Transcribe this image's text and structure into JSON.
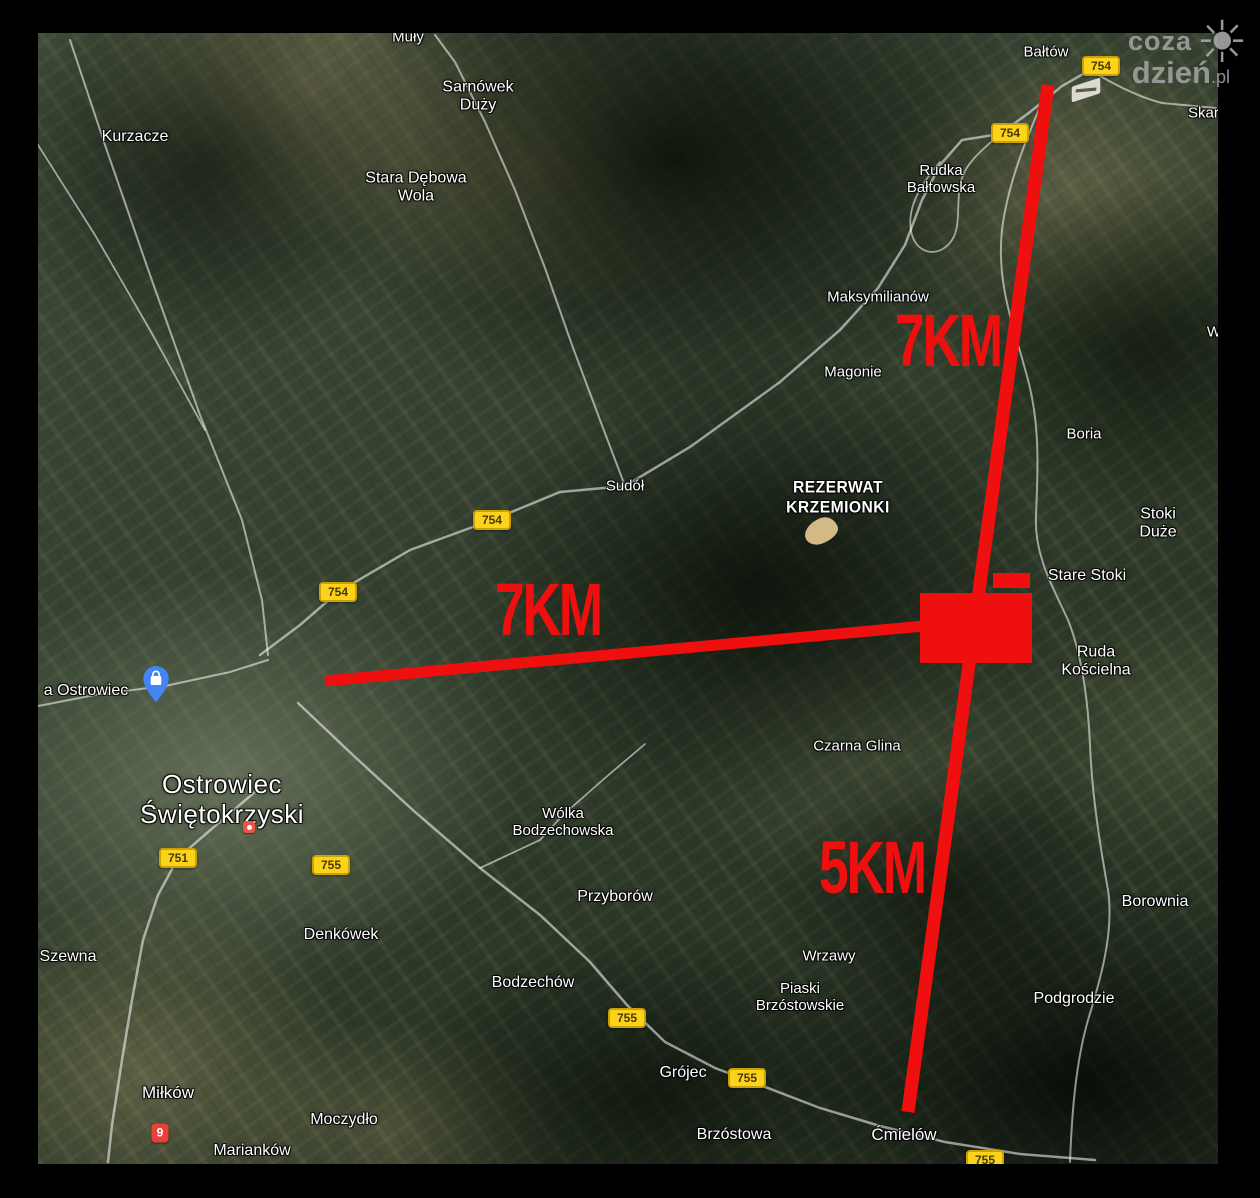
{
  "page": {
    "bg": "#000000",
    "map": {
      "left": 38,
      "top": 33,
      "width": 1180,
      "height": 1131
    }
  },
  "colors": {
    "annotation_red": "#ef0f0f",
    "shield_bg": "#fcd21b",
    "pin_blue": "#4285f4",
    "marker_red": "#e8413c",
    "label_white": "#ffffff",
    "road_white": "rgba(255,255,255,0.55)"
  },
  "watermark": {
    "line1": "coza",
    "line2": "dzień",
    "tld": ".pl",
    "sun_glyph": "☀"
  },
  "map_labels": [
    {
      "text": "Muły",
      "x": 408,
      "y": 37
    },
    {
      "text": "Kurzacze",
      "x": 135,
      "y": 137,
      "size": 16
    },
    {
      "text": "Sarnówek\nDuży",
      "x": 478,
      "y": 97,
      "size": 16
    },
    {
      "text": "Stara Dębowa\nWola",
      "x": 416,
      "y": 188,
      "size": 16
    },
    {
      "text": "Bałtów",
      "x": 1046,
      "y": 52
    },
    {
      "text": "Skarbka",
      "x": 1188,
      "y": 113,
      "anchor": "left"
    },
    {
      "text": "Rudka\nBałtowska",
      "x": 941,
      "y": 179
    },
    {
      "text": "Maksymilianów",
      "x": 878,
      "y": 297
    },
    {
      "text": "Magonie",
      "x": 853,
      "y": 372
    },
    {
      "text": "Boria",
      "x": 1084,
      "y": 434
    },
    {
      "text": "W",
      "x": 1214,
      "y": 332
    },
    {
      "text": "Sudół",
      "x": 625,
      "y": 486
    },
    {
      "text": "REZERWAT\nKRZEMIONKI",
      "x": 838,
      "y": 497,
      "cls": "reserve"
    },
    {
      "text": "Stoki Duże",
      "x": 1158,
      "y": 524,
      "size": 16
    },
    {
      "text": "Stare Stoki",
      "x": 1087,
      "y": 576,
      "size": 16
    },
    {
      "text": "Ruda\nKościelna",
      "x": 1096,
      "y": 662,
      "size": 16
    },
    {
      "text": "Czarna Glina",
      "x": 857,
      "y": 746
    },
    {
      "text": "a Ostrowiec",
      "x": 86,
      "y": 691,
      "size": 16
    },
    {
      "text": "Ostrowiec\nŚwiętokrzyski",
      "x": 222,
      "y": 800,
      "cls": "city"
    },
    {
      "text": "Wólka\nBodzechowska",
      "x": 563,
      "y": 822
    },
    {
      "text": "Przyborów",
      "x": 615,
      "y": 897,
      "size": 16
    },
    {
      "text": "Wrzawy",
      "x": 829,
      "y": 956
    },
    {
      "text": "Piaski\nBrzóstowskie",
      "x": 800,
      "y": 997
    },
    {
      "text": "Szewna",
      "x": 68,
      "y": 957,
      "size": 16
    },
    {
      "text": "Denkówek",
      "x": 341,
      "y": 935,
      "size": 16
    },
    {
      "text": "Bodzechów",
      "x": 533,
      "y": 983,
      "size": 16
    },
    {
      "text": "Borownia",
      "x": 1155,
      "y": 902,
      "size": 16
    },
    {
      "text": "Podgrodzie",
      "x": 1074,
      "y": 999,
      "size": 16
    },
    {
      "text": "Grójec",
      "x": 683,
      "y": 1073,
      "size": 16
    },
    {
      "text": "Brzóstowa",
      "x": 734,
      "y": 1135,
      "size": 16
    },
    {
      "text": "Ćmielów",
      "x": 904,
      "y": 1135,
      "size": 17
    },
    {
      "text": "Miłków",
      "x": 168,
      "y": 1093,
      "size": 17
    },
    {
      "text": "Moczydło",
      "x": 344,
      "y": 1120,
      "size": 16
    },
    {
      "text": "Marianków",
      "x": 252,
      "y": 1151,
      "size": 16
    }
  ],
  "road_shields": [
    {
      "label": "754",
      "x": 1101,
      "y": 66
    },
    {
      "label": "754",
      "x": 1010,
      "y": 133
    },
    {
      "label": "754",
      "x": 492,
      "y": 520
    },
    {
      "label": "754",
      "x": 338,
      "y": 592
    },
    {
      "label": "751",
      "x": 178,
      "y": 858
    },
    {
      "label": "755",
      "x": 331,
      "y": 865
    },
    {
      "label": "755",
      "x": 627,
      "y": 1018
    },
    {
      "label": "755",
      "x": 747,
      "y": 1078
    },
    {
      "label": "755",
      "x": 985,
      "y": 1160
    }
  ],
  "annotations": {
    "distance_labels": [
      {
        "text": "7KM",
        "x": 948,
        "y": 341
      },
      {
        "text": "7KM",
        "x": 548,
        "y": 610
      },
      {
        "text": "5KM",
        "x": 872,
        "y": 868
      }
    ],
    "lines": [
      {
        "x1": 1048,
        "y1": 85,
        "x2": 908,
        "y2": 1112,
        "width": 13
      },
      {
        "x1": 325,
        "y1": 681,
        "x2": 924,
        "y2": 626,
        "width": 11
      }
    ],
    "rects": [
      {
        "x": 920,
        "y": 593,
        "w": 112,
        "h": 70
      },
      {
        "x": 993,
        "y": 573,
        "w": 37,
        "h": 15
      }
    ]
  },
  "poi": {
    "shopping_pin": {
      "x": 156,
      "y": 702
    },
    "ostrowiec_poi": {
      "x": 249,
      "y": 827
    },
    "red_marker_9": {
      "x": 160,
      "y": 1133,
      "label": "9"
    },
    "airstrip": {
      "x": 1086,
      "y": 90
    },
    "reserve_blob": {
      "x": 821,
      "y": 531
    }
  },
  "roads": [
    {
      "d": "M260,655 L300,625 L338,592 L410,550 L492,520 L560,492 L625,486 L690,447 L780,382 L840,330 L878,288 L905,245 L922,200 L940,165 L962,140 L1000,134 L1030,112 L1062,86 L1090,70",
      "w": 2.5
    },
    {
      "d": "M1090,70 C1110,82 1135,96 1162,103 L1216,108",
      "w": 2
    },
    {
      "d": "M625,486 L600,420 L572,345 L545,268 L515,190 L485,122 L455,62 L435,35",
      "w": 2
    },
    {
      "d": "M255,792 L215,826 L178,858 L158,895 L143,940 L132,1000 L122,1060 L112,1125 L108,1162",
      "w": 2.5
    },
    {
      "d": "M298,703 L355,757 L415,812 L480,868 L540,915 L590,962 L627,1005 L665,1042 L715,1068 L760,1085 L820,1108 L880,1126 L945,1142 L1020,1154 L1095,1160",
      "w": 2.5
    },
    {
      "d": "M38,706 L100,694 L165,686 L230,672 L268,660",
      "w": 2
    },
    {
      "d": "M1048,88 C1030,130 1008,180 1002,230 C996,285 1015,330 1028,380 C1040,425 1038,470 1036,515 C1034,555 1052,585 1068,620 C1082,655 1088,700 1090,745 C1092,795 1100,845 1108,890 C1114,930 1102,975 1088,1020 C1076,1062 1072,1110 1070,1162",
      "w": 2
    },
    {
      "d": "M70,40 L105,145 L150,275 L200,415 L242,520 L262,600 L268,655",
      "w": 2
    },
    {
      "d": "M940,162 C920,185 905,210 912,235 C918,255 940,258 952,240 C962,225 955,200 962,178 C968,160 985,148 1000,134",
      "w": 1.8
    },
    {
      "d": "M480,868 L540,840 L563,815 L605,778 L645,744",
      "w": 1.8
    },
    {
      "d": "M38,145 L95,235 L150,330 L205,430",
      "w": 1.8
    }
  ]
}
